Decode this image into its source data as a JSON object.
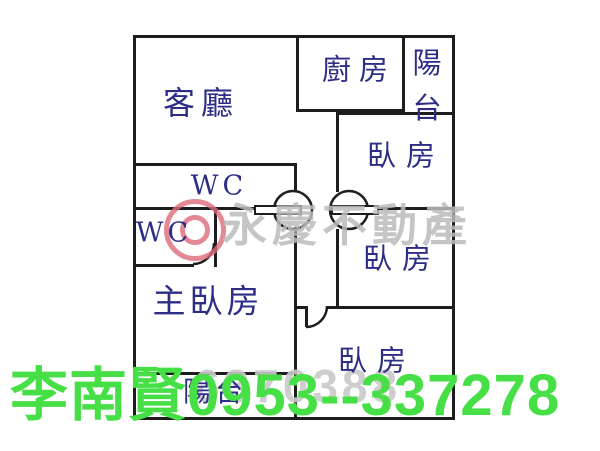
{
  "colors": {
    "wall": "#1d1d1d",
    "room_label": "#2d2d86",
    "contact_green": "#46df46",
    "watermark_gray": "#bcbcbc",
    "watermark_red": "#dc6a7a",
    "photo_id_gray": "#c9c9c9",
    "background": "#ffffff"
  },
  "plan": {
    "rooms": [
      {
        "id": "living-room",
        "label": "客廳"
      },
      {
        "id": "kitchen",
        "label": "廚房"
      },
      {
        "id": "balcony-top",
        "label": "陽台"
      },
      {
        "id": "bedroom-top",
        "label": "臥房"
      },
      {
        "id": "wc-upper",
        "label": "WC"
      },
      {
        "id": "wc-lower",
        "label": "WC"
      },
      {
        "id": "master-bedroom",
        "label": "主臥房"
      },
      {
        "id": "bedroom-middle",
        "label": "臥房"
      },
      {
        "id": "bedroom-bottom",
        "label": "臥房"
      },
      {
        "id": "balcony-bottom",
        "label": "陽台"
      }
    ]
  },
  "watermark": {
    "brand_text": "永慶不動產",
    "photo_id": "6370388"
  },
  "contact_overlay": {
    "text": "李南賢0953--337278"
  }
}
